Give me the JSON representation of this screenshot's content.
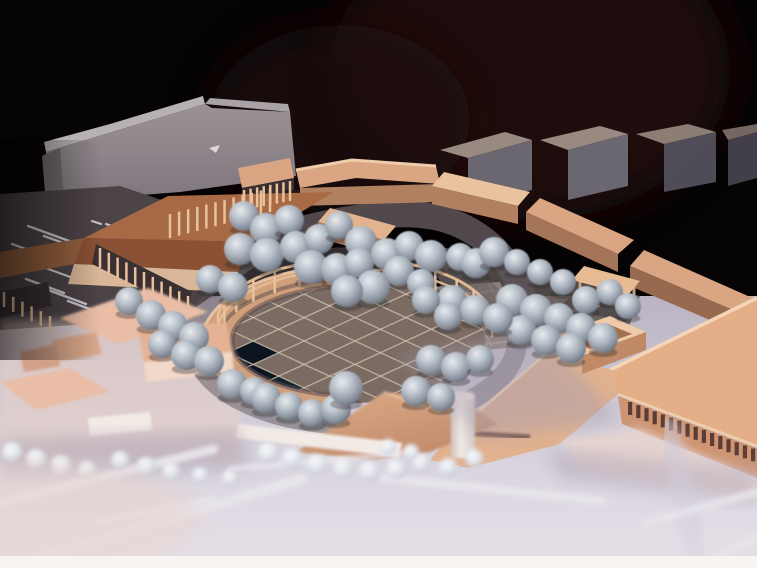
{
  "meta": {
    "title": "Architectural scale model photograph",
    "description": "Oblique photograph of a physical urban-design scale model on a dark background: tan card buildings arranged around an elliptical colonnaded plaza with a diamond-grid paved floor, a long gray slab building and gray context blocks behind, dozens of gray sphere trees, a brown-roofed colonnaded hall on the left, a large arcaded corner building at front right, and pale out-of-focus roads with white lane markings in the foreground. A white photo border runs along the bottom edge."
  },
  "palette": {
    "background": "#060304",
    "maroon_glow": "#240c0f",
    "maroon_glow2": "#1b080a",
    "slab_face_dark": "#6e666c",
    "slab_top": "#b7b1b5",
    "slab_top2": "#a9a2a7",
    "block_top": "#998a81",
    "block_face": "#6b6770",
    "block_face_dark": "#575460",
    "parking": "#4c4347",
    "marking": "#d9d5dc",
    "walkway": "#5e5559",
    "courtyard": "#5b534f",
    "pink_base": "#e9d0c6",
    "tan_top": "#d9a582",
    "tan_top_bright": "#e9c2a0",
    "tan_top_light": "#e2b38e",
    "tan_face": "#b08060",
    "tan_face_dark": "#a5755a",
    "tan_face_darker": "#97694f",
    "tan_edge": "#efcdaa",
    "door": "#231a1d",
    "col_dark": "#352b2e",
    "col_dark2": "#3a3033",
    "post": "#e8c29c",
    "roof_brown": "#a86a44",
    "roof_brown_dark": "#8a5134",
    "roof_brown_left": "#94603e",
    "cream_face": "#d9b697",
    "ring": "#d0a07d",
    "ring_hl": "#ecc8a6",
    "ring_shadow": "#5c4f52",
    "plaza_floor": "#7b6b62",
    "plaza_grid": "#cfc2b0",
    "tile_dark1": "#0c1420",
    "tile_dark2": "#16222e",
    "apron": "#8a7e78",
    "apron_grid": "#a89d94",
    "rail": "#e6bd97",
    "arc_shadow": "#4e4347",
    "big_roof": "#e4ae88",
    "big_roof_hl": "#f4d6b6",
    "big_roof_hl2": "#f0cdaa",
    "big_mass": "#e0b18f",
    "slot_face": "#cf9572",
    "slot": "#5a3e36",
    "box_top": "#eecaa9",
    "box_recess": "#a2714f",
    "box_front": "#c08a66",
    "pavilion_top": "#e8bb95",
    "pavilion_leg": "#c9a07c",
    "pav_shadow": "#423a3e",
    "fascia": "#f2ebe5",
    "canopy": "#5a3c34",
    "pink_roof": "#e9bda6",
    "pink_top": "#e6b295",
    "pink_face": "#f2d8c8",
    "pink_small": "#dba98c",
    "pink_small2": "#d2a086",
    "tree_shadow": "#2e282c",
    "stripe": "#eceaf0",
    "stripe_faint": "#cfcad8",
    "shadow_band": "#a79dae",
    "haze_pink": "#e8d4ce",
    "border_white": "#f7f4f1"
  },
  "trees": {
    "large": [
      [
        244,
        216,
        15
      ],
      [
        266,
        229,
        16
      ],
      [
        289,
        220,
        15
      ],
      [
        240,
        249,
        16
      ],
      [
        267,
        255,
        17
      ],
      [
        296,
        247,
        16
      ],
      [
        319,
        239,
        15
      ],
      [
        339,
        225,
        14
      ],
      [
        361,
        242,
        16
      ],
      [
        311,
        267,
        17
      ],
      [
        337,
        269,
        16
      ],
      [
        359,
        263,
        15
      ],
      [
        387,
        254,
        16
      ],
      [
        409,
        246,
        15
      ],
      [
        431,
        256,
        16
      ],
      [
        399,
        271,
        15
      ],
      [
        373,
        287,
        17
      ],
      [
        347,
        291,
        16
      ],
      [
        421,
        283,
        14
      ],
      [
        129,
        301,
        14
      ],
      [
        151,
        315,
        15
      ],
      [
        173,
        326,
        15
      ],
      [
        194,
        337,
        15
      ],
      [
        162,
        344,
        14
      ],
      [
        186,
        355,
        15
      ],
      [
        209,
        361,
        15
      ],
      [
        232,
        384,
        15
      ],
      [
        254,
        391,
        14
      ],
      [
        210,
        279,
        14
      ],
      [
        233,
        287,
        15
      ],
      [
        266,
        398,
        15
      ],
      [
        289,
        406,
        14
      ],
      [
        312,
        413,
        14
      ],
      [
        336,
        409,
        15
      ],
      [
        346,
        388,
        17
      ],
      [
        460,
        257,
        14
      ],
      [
        476,
        263,
        15
      ],
      [
        494,
        252,
        15
      ],
      [
        517,
        262,
        13
      ],
      [
        540,
        272,
        13
      ],
      [
        563,
        282,
        13
      ],
      [
        586,
        300,
        14
      ],
      [
        610,
        292,
        13
      ],
      [
        628,
        306,
        13
      ],
      [
        512,
        300,
        16
      ],
      [
        536,
        310,
        16
      ],
      [
        559,
        318,
        15
      ],
      [
        581,
        328,
        15
      ],
      [
        603,
        338,
        15
      ],
      [
        521,
        330,
        15
      ],
      [
        546,
        340,
        15
      ],
      [
        452,
        300,
        15
      ],
      [
        475,
        310,
        15
      ],
      [
        498,
        318,
        15
      ],
      [
        426,
        300,
        14
      ],
      [
        448,
        316,
        14
      ],
      [
        571,
        348,
        15
      ],
      [
        431,
        360,
        15
      ],
      [
        456,
        367,
        15
      ],
      [
        480,
        359,
        14
      ],
      [
        416,
        391,
        15
      ],
      [
        441,
        397,
        14
      ]
    ],
    "small": [
      [
        12,
        452,
        10
      ],
      [
        36,
        459,
        10
      ],
      [
        61,
        465,
        10
      ],
      [
        87,
        470,
        9
      ],
      [
        120,
        460,
        9
      ],
      [
        146,
        466,
        9
      ],
      [
        171,
        471,
        9
      ],
      [
        268,
        452,
        10
      ],
      [
        292,
        458,
        10
      ],
      [
        317,
        464,
        10
      ],
      [
        343,
        468,
        10
      ],
      [
        369,
        471,
        10
      ],
      [
        396,
        469,
        10
      ],
      [
        421,
        463,
        9
      ],
      [
        448,
        467,
        9
      ],
      [
        474,
        458,
        9
      ],
      [
        388,
        447,
        8
      ],
      [
        411,
        452,
        8
      ],
      [
        200,
        475,
        8
      ],
      [
        230,
        478,
        8
      ]
    ]
  },
  "plaza": {
    "colonnade": {
      "cx": 355,
      "cy": 341,
      "rx": 138,
      "ry": 64,
      "a0": 187,
      "a1": 353,
      "count": 15,
      "lift": 18,
      "post_h": 22
    },
    "grid": {
      "spacing": 36,
      "extent": 228,
      "lines": 13
    },
    "dark_cells": [
      [
        -72,
        72
      ],
      [
        -72,
        108
      ],
      [
        -36,
        108
      ],
      [
        0,
        108
      ],
      [
        -36,
        144
      ],
      [
        0,
        144
      ]
    ]
  },
  "colonnades": [
    {
      "x1": 170,
      "y1": 214,
      "x2": 270,
      "y2": 188,
      "count": 12,
      "h": 24
    },
    {
      "x1": 100,
      "y1": 248,
      "x2": 188,
      "y2": 296,
      "count": 11,
      "h": 20
    },
    {
      "x1": 244,
      "y1": 190,
      "x2": 290,
      "y2": 181,
      "count": 8,
      "h": 20
    },
    {
      "x1": 4,
      "y1": 292,
      "x2": 50,
      "y2": 316,
      "count": 6,
      "h": 15
    }
  ],
  "window_slots": {
    "x": 628,
    "y": 402,
    "dx": 8.2,
    "dy": 3.1,
    "w": 4.2,
    "h": 13,
    "count": 16
  },
  "apron_lines": [
    [
      390,
      300,
      505,
      290
    ],
    [
      398,
      318,
      516,
      306
    ],
    [
      408,
      336,
      528,
      322
    ],
    [
      418,
      352,
      538,
      338
    ],
    [
      398,
      292,
      432,
      352
    ],
    [
      428,
      288,
      462,
      350
    ],
    [
      458,
      285,
      492,
      346
    ],
    [
      488,
      283,
      520,
      342
    ]
  ],
  "parking_markings": [
    [
      28,
      226,
      72,
      242,
      2.5
    ],
    [
      44,
      236,
      88,
      252,
      2.5
    ],
    [
      12,
      244,
      56,
      260,
      2.5
    ],
    [
      60,
      254,
      104,
      270,
      2.5
    ],
    [
      40,
      266,
      84,
      282,
      2
    ],
    [
      92,
      221,
      101,
      224,
      2
    ],
    [
      106,
      224,
      115,
      227,
      2
    ],
    [
      120,
      227,
      129,
      230,
      2
    ],
    [
      188,
      198,
      196,
      201,
      2
    ],
    [
      199,
      202,
      207,
      205,
      2
    ],
    [
      210,
      206,
      218,
      209,
      2
    ],
    [
      48,
      290,
      86,
      304,
      2.5
    ],
    [
      26,
      279,
      64,
      293,
      2.5
    ],
    [
      68,
      301,
      106,
      315,
      2.5
    ]
  ],
  "road_stripes": [
    [
      0,
      503,
      214,
      449,
      9
    ],
    [
      14,
      566,
      302,
      479,
      11
    ],
    [
      230,
      469,
      406,
      453,
      5
    ],
    [
      384,
      478,
      602,
      501,
      9
    ],
    [
      646,
      523,
      757,
      492,
      8
    ],
    [
      700,
      566,
      757,
      537,
      8
    ],
    [
      96,
      523,
      212,
      499,
      6
    ]
  ],
  "road_stripes_faint": [
    [
      668,
      430,
      700,
      564,
      24
    ]
  ]
}
